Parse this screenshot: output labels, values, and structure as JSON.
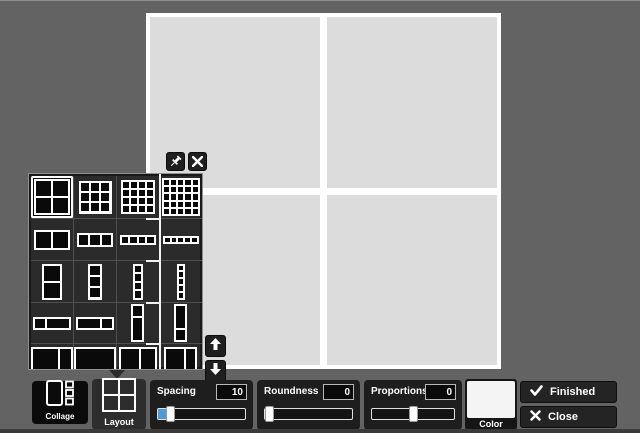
{
  "colors": {
    "background": "#636363",
    "canvas_cell": "#dcdcdc",
    "canvas_frame": "#ffffff",
    "popup_bg": "#2b2b2b",
    "panel_bg": "#1e1e1e",
    "accent_blue": "#4d9ad8",
    "swatch_color": "#f4f4f4"
  },
  "canvas": {
    "rows": 2,
    "cols": 2
  },
  "layout_popup": {
    "pin_icon": "pushpin-icon",
    "close_icon": "close-icon",
    "scroll_up_icon": "arrow-up-icon",
    "scroll_down_icon": "arrow-down-icon",
    "items": [
      {
        "name": "grid-2x2",
        "kind": "grid",
        "rows": 2,
        "cols": 2,
        "w": 36,
        "h": 36,
        "selected": true
      },
      {
        "name": "grid-3x3",
        "kind": "grid",
        "rows": 3,
        "cols": 3,
        "w": 33,
        "h": 33
      },
      {
        "name": "grid-4x4",
        "kind": "grid",
        "rows": 4,
        "cols": 4,
        "w": 34,
        "h": 34
      },
      {
        "name": "grid-5x5",
        "kind": "grid",
        "rows": 5,
        "cols": 5,
        "w": 38,
        "h": 38
      },
      {
        "name": "columns-2",
        "kind": "grid",
        "rows": 1,
        "cols": 2,
        "w": 36,
        "h": 20
      },
      {
        "name": "columns-3",
        "kind": "grid",
        "rows": 1,
        "cols": 3,
        "w": 36,
        "h": 14
      },
      {
        "name": "columns-4",
        "kind": "grid",
        "rows": 1,
        "cols": 4,
        "w": 36,
        "h": 10
      },
      {
        "name": "columns-5",
        "kind": "grid",
        "rows": 1,
        "cols": 5,
        "w": 36,
        "h": 8
      },
      {
        "name": "rows-2",
        "kind": "grid",
        "rows": 2,
        "cols": 1,
        "w": 20,
        "h": 36
      },
      {
        "name": "rows-3",
        "kind": "grid",
        "rows": 3,
        "cols": 1,
        "w": 14,
        "h": 36
      },
      {
        "name": "rows-4",
        "kind": "grid",
        "rows": 4,
        "cols": 1,
        "w": 10,
        "h": 36
      },
      {
        "name": "rows-5",
        "kind": "grid",
        "rows": 5,
        "cols": 1,
        "w": 8,
        "h": 36
      },
      {
        "name": "wide-small-left",
        "kind": "split-h",
        "split": 0.32,
        "w": 38,
        "h": 13
      },
      {
        "name": "wide-small-right",
        "kind": "split-h",
        "split": 0.68,
        "w": 38,
        "h": 13
      },
      {
        "name": "tall-small-top",
        "kind": "split-v",
        "split": 0.32,
        "w": 13,
        "h": 38
      },
      {
        "name": "tall-small-bottom",
        "kind": "split-v",
        "split": 0.68,
        "w": 13,
        "h": 38
      },
      {
        "name": "big-split-left",
        "kind": "split-h",
        "split": 0.7,
        "w": 42,
        "h": 36
      },
      {
        "name": "big-single",
        "kind": "grid",
        "rows": 1,
        "cols": 1,
        "w": 42,
        "h": 36
      },
      {
        "name": "big-split-center",
        "kind": "split-h",
        "split": 0.56,
        "w": 38,
        "h": 36
      },
      {
        "name": "big-split-right",
        "kind": "split-h",
        "split": 0.64,
        "w": 33,
        "h": 36
      }
    ]
  },
  "toolbar": {
    "collage": {
      "label": "Collage"
    },
    "layout": {
      "label": "Layout"
    },
    "sliders": [
      {
        "name": "spacing",
        "label": "Spacing",
        "value": "10",
        "position": 0.1,
        "fill_to_handle": true
      },
      {
        "name": "roundness",
        "label": "Roundness",
        "value": "0",
        "position": 0.0,
        "fill_to_handle": false
      },
      {
        "name": "proportions",
        "label": "Proportions",
        "value": "0",
        "position": 0.5,
        "fill_to_handle": false
      }
    ],
    "color": {
      "label": "Color"
    },
    "finished": {
      "label": "Finished"
    },
    "close": {
      "label": "Close"
    }
  }
}
